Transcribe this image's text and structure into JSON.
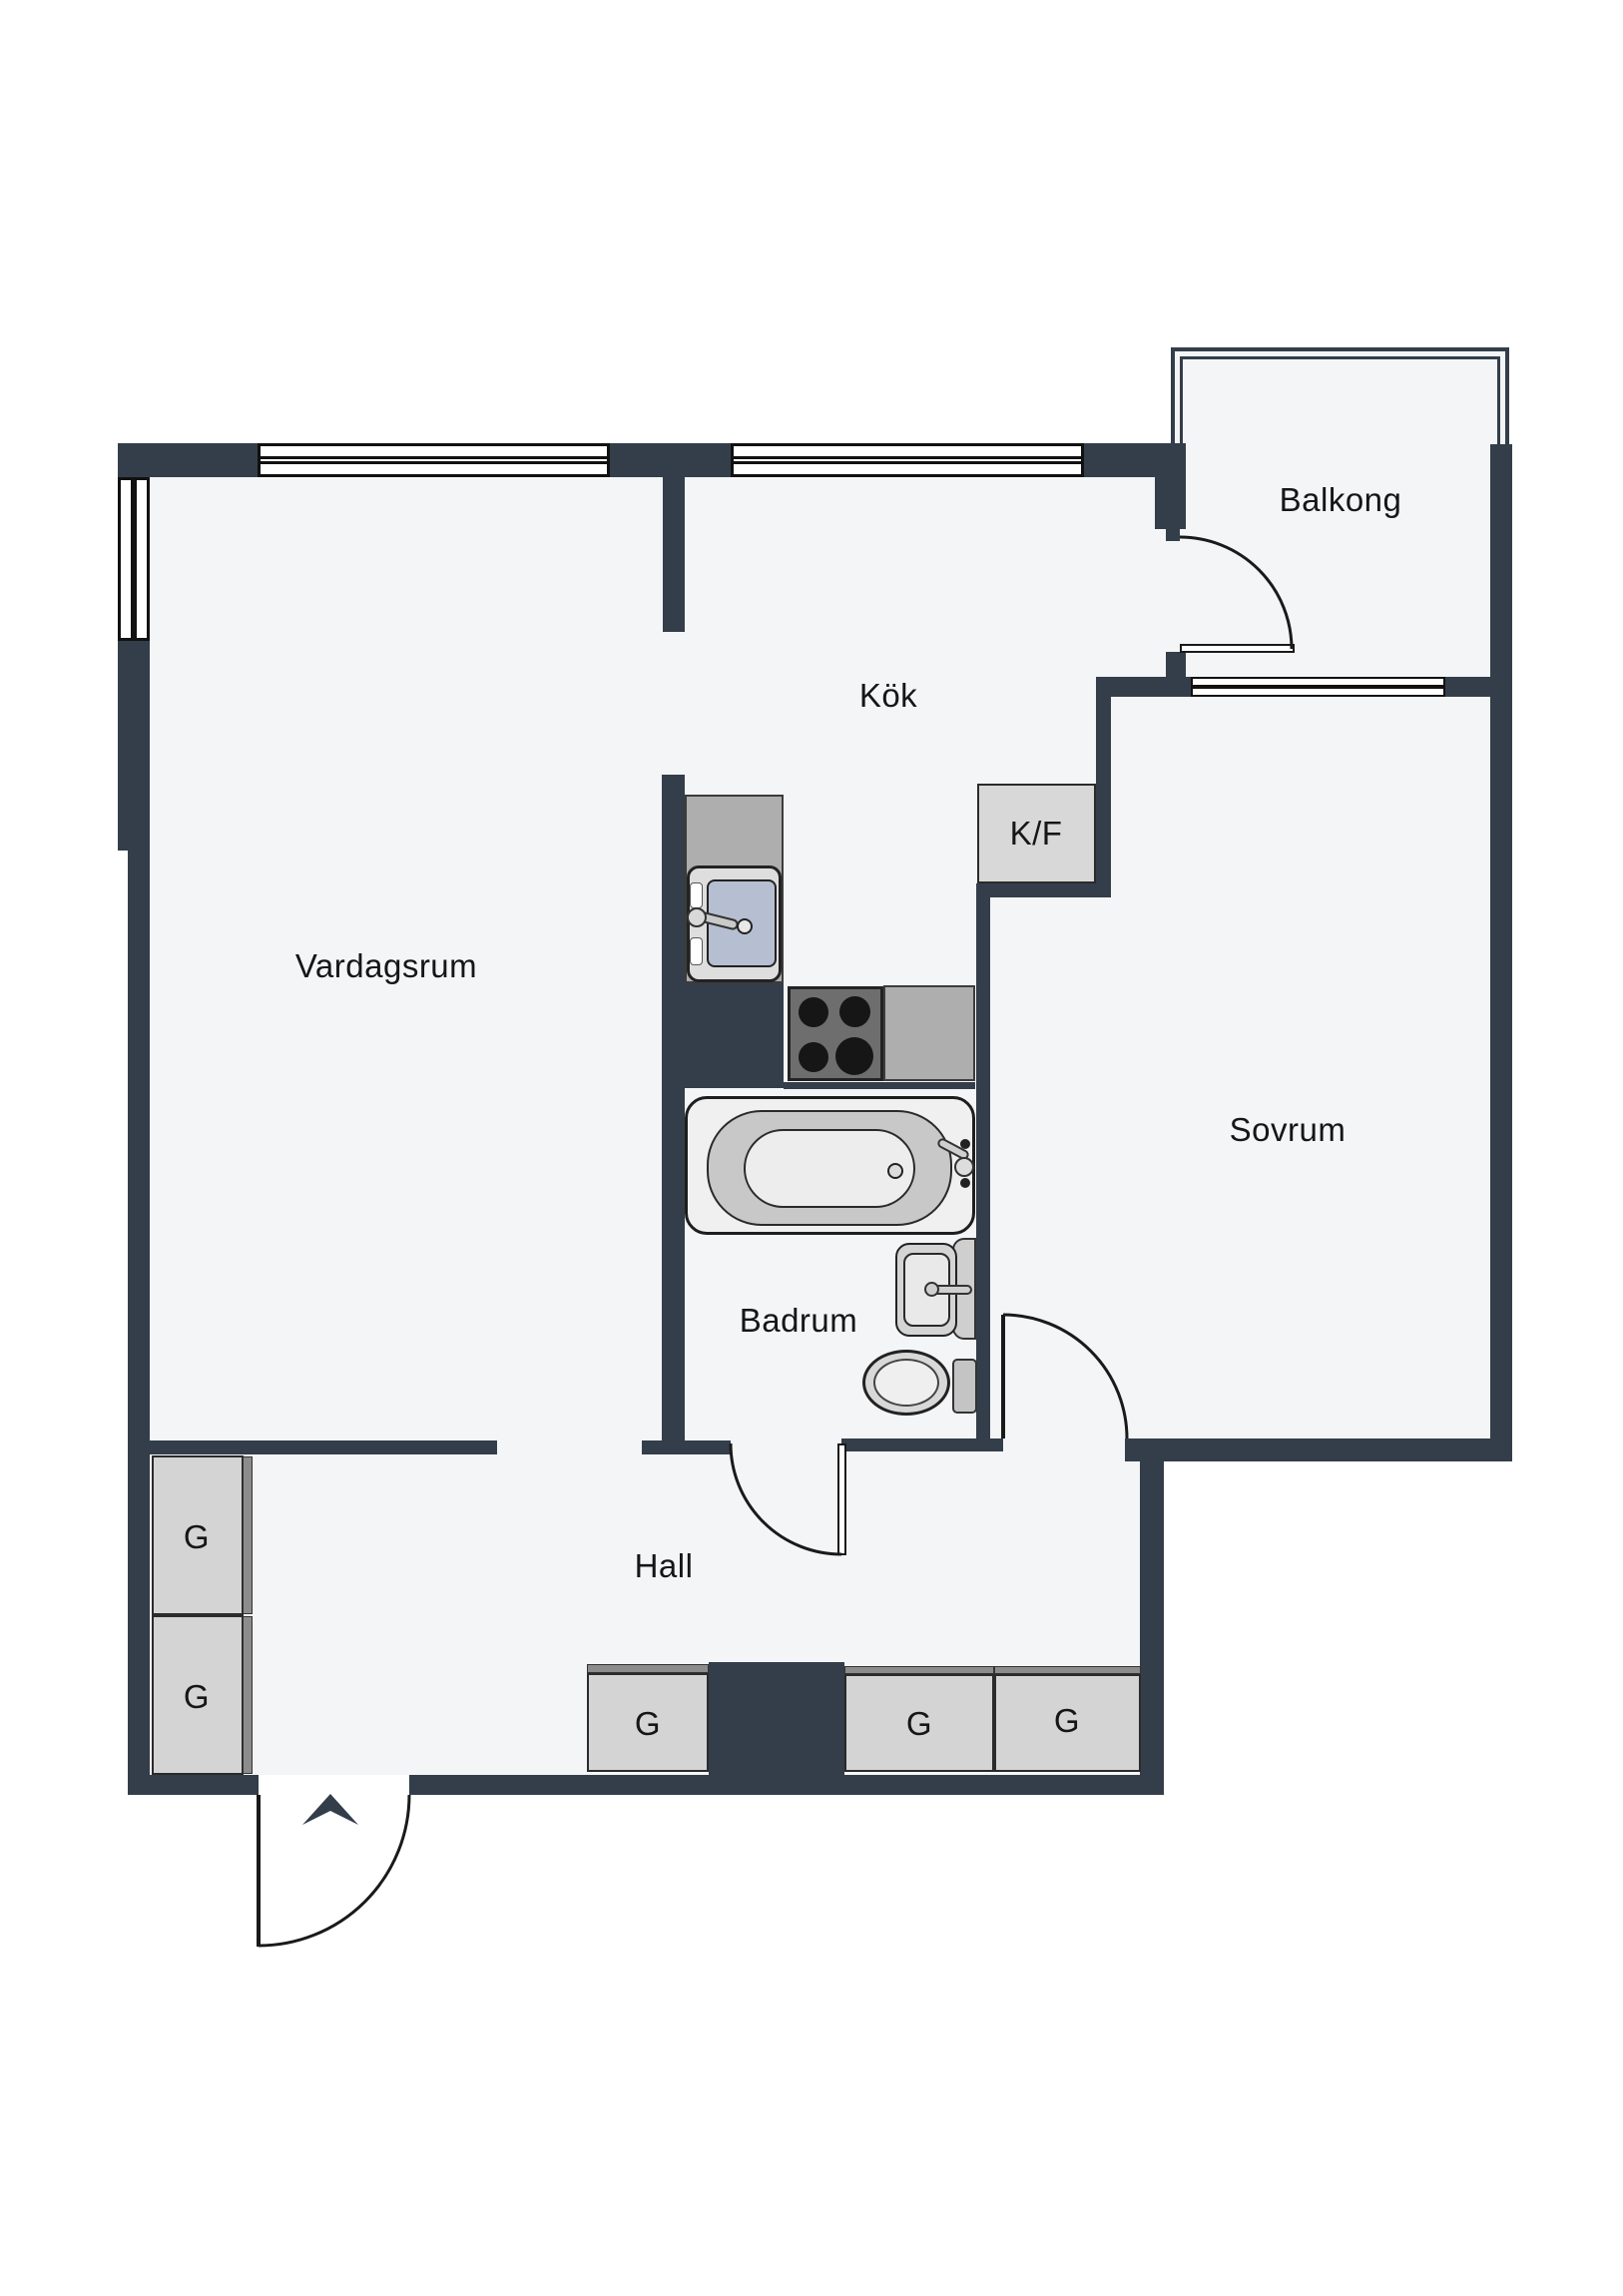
{
  "plan_type": "apartment-floor-plan",
  "rooms": {
    "vardagsrum": {
      "label": "Vardagsrum"
    },
    "kok": {
      "label": "Kök"
    },
    "sovrum": {
      "label": "Sovrum"
    },
    "badrum": {
      "label": "Badrum"
    },
    "hall": {
      "label": "Hall"
    },
    "balkong": {
      "label": "Balkong"
    }
  },
  "fixtures": {
    "fridge_freezer": {
      "label": "K/F"
    },
    "wardrobe": {
      "label": "G",
      "count": 5
    },
    "icons": [
      "kitchen-sink-icon",
      "stove-icon",
      "bathtub-icon",
      "washbasin-icon",
      "toilet-icon",
      "entry-arrow-icon",
      "door-arc-icon",
      "window-icon"
    ]
  },
  "colors": {
    "wall": "#333e4a",
    "floor": "#f4f5f7",
    "fixture_fill": "#d4d4d4",
    "fixture_dark": "#8c8c8c",
    "counter": "#aeaeae",
    "hob": "#6e6e6e",
    "outline": "#1c1c1c",
    "sink_basin": "#b5bfd1",
    "page_bg": "#ffffff"
  }
}
